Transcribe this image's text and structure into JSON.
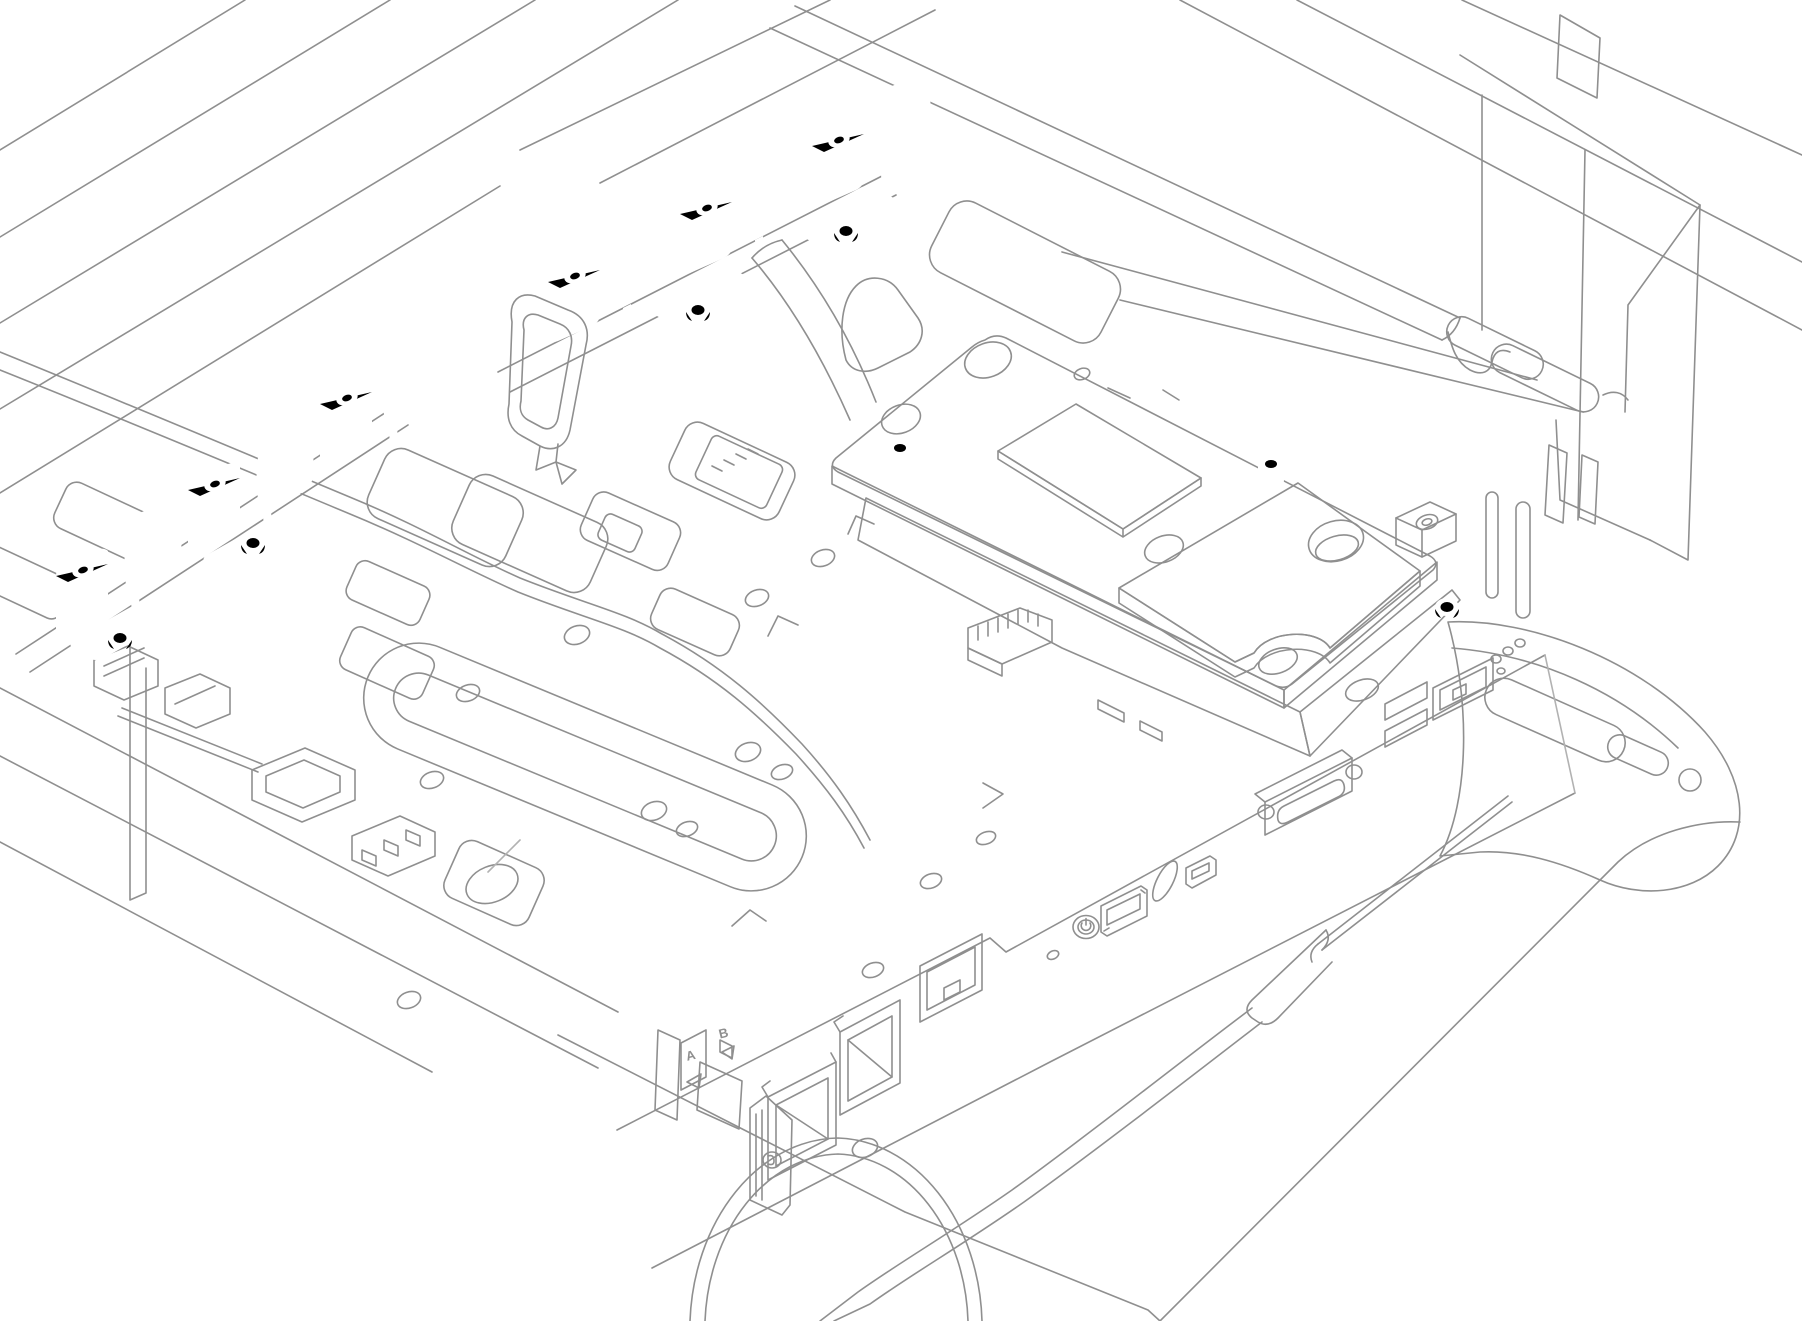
{
  "illustration": {
    "background": "#ffffff",
    "line_color": "#8f8f8f",
    "line_color_light": "#b2b2b2",
    "highlight_outline": "#141414",
    "cold_plate_fill": "#ececec",
    "cold_plate_side_fill": "#dfdfdf",
    "shelf_fill": "#f2f2f2",
    "pad_top_fill": "#8a8a8a",
    "pad_side_fill": "#6f6f6f",
    "hole_inner_fill": "#e9e9e9"
  },
  "labels": {
    "node_a": "A",
    "node_b": "B"
  }
}
